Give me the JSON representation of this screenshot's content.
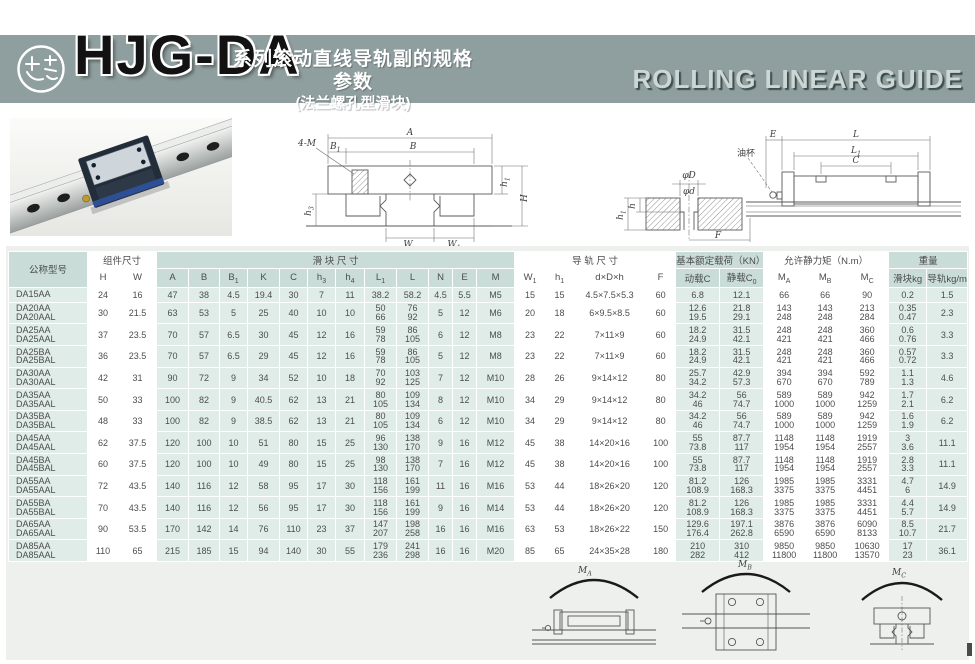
{
  "header": {
    "series": "HJG-DA",
    "subtitle_line1": "系列滚动直线导轨副的规格参数",
    "subtitle_line2": "(法兰螺孔型滑块)",
    "right_title": "ROLLING LINEAR GUIDE",
    "brand_color": "#8f9e9e"
  },
  "figures": {
    "front_view": {
      "bolt": "4-M",
      "a": "A",
      "b": "B",
      "b1": "B_1",
      "h1": "h_1",
      "h3": "h_3",
      "h": "H",
      "w": "W",
      "w1": "W_1"
    },
    "side_view": {
      "e": "E",
      "l": "L",
      "l1": "L_1",
      "c": "C",
      "oil": "油杯",
      "phiD": "φD",
      "phid": "φd",
      "h": "h",
      "h1": "h_1",
      "f": "F"
    },
    "moments": {
      "ma": "M_A",
      "mb": "M_B",
      "mc": "M_C"
    }
  },
  "table": {
    "groups": [
      {
        "label": "公称型号"
      },
      {
        "label": "组件尺寸"
      },
      {
        "label": "滑  块  尺  寸"
      },
      {
        "label": "导  轨  尺  寸"
      },
      {
        "label": "基本额定载荷（KN）"
      },
      {
        "label": "允许静力矩（N.m）"
      },
      {
        "label": "重量"
      }
    ],
    "columns": [
      "H",
      "W",
      "A",
      "B",
      "B_1",
      "K",
      "C",
      "h_3",
      "h_4",
      "L_1",
      "L",
      "N",
      "E",
      "M",
      "W_1",
      "h_1",
      "d×D×h",
      "F",
      "动载C",
      "静载C_0",
      "M_A",
      "M_B",
      "M_C",
      "滑块kg",
      "导轨kg/m"
    ],
    "rows": [
      {
        "model": [
          "DA15AA"
        ],
        "cells": [
          "24",
          "16",
          "47",
          "38",
          "4.5",
          "19.4",
          "30",
          "7",
          "11",
          "38.2",
          "58.2",
          "4.5",
          "5.5",
          "M5",
          "15",
          "15",
          "4.5×7.5×5.3",
          "60",
          "6.8",
          "12.1",
          "66",
          "66",
          "90",
          "0.2",
          "1.5"
        ]
      },
      {
        "model": [
          "DA20AA",
          "DA20AAL"
        ],
        "cells": [
          "30",
          "21.5",
          "63",
          "53",
          "5",
          "25",
          "40",
          "10",
          "10",
          [
            "50",
            "66"
          ],
          [
            "76",
            "92"
          ],
          "5",
          "12",
          "M6",
          "20",
          "18",
          "6×9.5×8.5",
          "60",
          [
            "12.6",
            "19.5"
          ],
          [
            "21.8",
            "29.1"
          ],
          [
            "143",
            "248"
          ],
          [
            "143",
            "248"
          ],
          [
            "213",
            "284"
          ],
          [
            "0.35",
            "0.47"
          ],
          "2.3"
        ]
      },
      {
        "model": [
          "DA25AA",
          "DA25AAL"
        ],
        "cells": [
          "37",
          "23.5",
          "70",
          "57",
          "6.5",
          "30",
          "45",
          "12",
          "16",
          [
            "59",
            "78"
          ],
          [
            "86",
            "105"
          ],
          "6",
          "12",
          "M8",
          "23",
          "22",
          "7×11×9",
          "60",
          [
            "18.2",
            "24.9"
          ],
          [
            "31.5",
            "42.1"
          ],
          [
            "248",
            "421"
          ],
          [
            "248",
            "421"
          ],
          [
            "360",
            "466"
          ],
          [
            "0.6",
            "0.76"
          ],
          "3.3"
        ]
      },
      {
        "model": [
          "DA25BA",
          "DA25BAL"
        ],
        "cells": [
          "36",
          "23.5",
          "70",
          "57",
          "6.5",
          "29",
          "45",
          "12",
          "16",
          [
            "59",
            "78"
          ],
          [
            "86",
            "105"
          ],
          "5",
          "12",
          "M8",
          "23",
          "22",
          "7×11×9",
          "60",
          [
            "18.2",
            "24.9"
          ],
          [
            "31.5",
            "42.1"
          ],
          [
            "248",
            "421"
          ],
          [
            "248",
            "421"
          ],
          [
            "360",
            "466"
          ],
          [
            "0.57",
            "0.72"
          ],
          "3.3"
        ]
      },
      {
        "model": [
          "DA30AA",
          "DA30AAL"
        ],
        "cells": [
          "42",
          "31",
          "90",
          "72",
          "9",
          "34",
          "52",
          "10",
          "18",
          [
            "70",
            "92"
          ],
          [
            "103",
            "125"
          ],
          "7",
          "12",
          "M10",
          "28",
          "26",
          "9×14×12",
          "80",
          [
            "25.7",
            "34.2"
          ],
          [
            "42.9",
            "57.3"
          ],
          [
            "394",
            "670"
          ],
          [
            "394",
            "670"
          ],
          [
            "592",
            "789"
          ],
          [
            "1.1",
            "1.3"
          ],
          "4.6"
        ]
      },
      {
        "model": [
          "DA35AA",
          "DA35AAL"
        ],
        "cells": [
          "50",
          "33",
          "100",
          "82",
          "9",
          "40.5",
          "62",
          "13",
          "21",
          [
            "80",
            "105"
          ],
          [
            "109",
            "134"
          ],
          "8",
          "12",
          "M10",
          "34",
          "29",
          "9×14×12",
          "80",
          [
            "34.2",
            "46"
          ],
          [
            "56",
            "74.7"
          ],
          [
            "589",
            "1000"
          ],
          [
            "589",
            "1000"
          ],
          [
            "942",
            "1259"
          ],
          [
            "1.7",
            "2.1"
          ],
          "6.2"
        ]
      },
      {
        "model": [
          "DA35BA",
          "DA35BAL"
        ],
        "cells": [
          "48",
          "33",
          "100",
          "82",
          "9",
          "38.5",
          "62",
          "13",
          "21",
          [
            "80",
            "105"
          ],
          [
            "109",
            "134"
          ],
          "6",
          "12",
          "M10",
          "34",
          "29",
          "9×14×12",
          "80",
          [
            "34.2",
            "46"
          ],
          [
            "56",
            "74.7"
          ],
          [
            "589",
            "1000"
          ],
          [
            "589",
            "1000"
          ],
          [
            "942",
            "1259"
          ],
          [
            "1.6",
            "1.9"
          ],
          "6.2"
        ]
      },
      {
        "model": [
          "DA45AA",
          "DA45AAL"
        ],
        "cells": [
          "62",
          "37.5",
          "120",
          "100",
          "10",
          "51",
          "80",
          "15",
          "25",
          [
            "96",
            "130"
          ],
          [
            "138",
            "170"
          ],
          "9",
          "16",
          "M12",
          "45",
          "38",
          "14×20×16",
          "100",
          [
            "55",
            "73.8"
          ],
          [
            "87.7",
            "117"
          ],
          [
            "1148",
            "1954"
          ],
          [
            "1148",
            "1954"
          ],
          [
            "1919",
            "2557"
          ],
          [
            "3",
            "3.6"
          ],
          "11.1"
        ]
      },
      {
        "model": [
          "DA45BA",
          "DA45BAL"
        ],
        "cells": [
          "60",
          "37.5",
          "120",
          "100",
          "10",
          "49",
          "80",
          "15",
          "25",
          [
            "98",
            "130"
          ],
          [
            "138",
            "170"
          ],
          "7",
          "16",
          "M12",
          "45",
          "38",
          "14×20×16",
          "100",
          [
            "55",
            "73.8"
          ],
          [
            "87.7",
            "117"
          ],
          [
            "1148",
            "1954"
          ],
          [
            "1148",
            "1954"
          ],
          [
            "1919",
            "2557"
          ],
          [
            "2.8",
            "3.3"
          ],
          "11.1"
        ]
      },
      {
        "model": [
          "DA55AA",
          "DA55AAL"
        ],
        "cells": [
          "72",
          "43.5",
          "140",
          "116",
          "12",
          "58",
          "95",
          "17",
          "30",
          [
            "118",
            "156"
          ],
          [
            "161",
            "199"
          ],
          "11",
          "16",
          "M16",
          "53",
          "44",
          "18×26×20",
          "120",
          [
            "81.2",
            "108.9"
          ],
          [
            "126",
            "168.3"
          ],
          [
            "1985",
            "3375"
          ],
          [
            "1985",
            "3375"
          ],
          [
            "3331",
            "4451"
          ],
          [
            "4.7",
            "6"
          ],
          "14.9"
        ]
      },
      {
        "model": [
          "DA55BA",
          "DA55BAL"
        ],
        "cells": [
          "70",
          "43.5",
          "140",
          "116",
          "12",
          "56",
          "95",
          "17",
          "30",
          [
            "118",
            "156"
          ],
          [
            "161",
            "199"
          ],
          "9",
          "16",
          "M14",
          "53",
          "44",
          "18×26×20",
          "120",
          [
            "81.2",
            "108.9"
          ],
          [
            "126",
            "168.3"
          ],
          [
            "1985",
            "3375"
          ],
          [
            "1985",
            "3375"
          ],
          [
            "3331",
            "4451"
          ],
          [
            "4.4",
            "5.7"
          ],
          "14.9"
        ]
      },
      {
        "model": [
          "DA65AA",
          "DA65AAL"
        ],
        "cells": [
          "90",
          "53.5",
          "170",
          "142",
          "14",
          "76",
          "110",
          "23",
          "37",
          [
            "147",
            "207"
          ],
          [
            "198",
            "258"
          ],
          "16",
          "16",
          "M16",
          "63",
          "53",
          "18×26×22",
          "150",
          [
            "129.6",
            "176.4"
          ],
          [
            "197.1",
            "262.8"
          ],
          [
            "3876",
            "6590"
          ],
          [
            "3876",
            "6590"
          ],
          [
            "6090",
            "8133"
          ],
          [
            "8.5",
            "10.7"
          ],
          "21.7"
        ]
      },
      {
        "model": [
          "DA85AA",
          "DA85AAL"
        ],
        "cells": [
          "110",
          "65",
          "215",
          "185",
          "15",
          "94",
          "140",
          "30",
          "55",
          [
            "179",
            "236"
          ],
          [
            "241",
            "298"
          ],
          "16",
          "16",
          "M20",
          "85",
          "65",
          "24×35×28",
          "180",
          [
            "210",
            "282"
          ],
          [
            "310",
            "412"
          ],
          [
            "9850",
            "11800"
          ],
          [
            "9850",
            "11800"
          ],
          [
            "10630",
            "13570"
          ],
          [
            "17",
            "23"
          ],
          "36.1"
        ]
      }
    ]
  }
}
